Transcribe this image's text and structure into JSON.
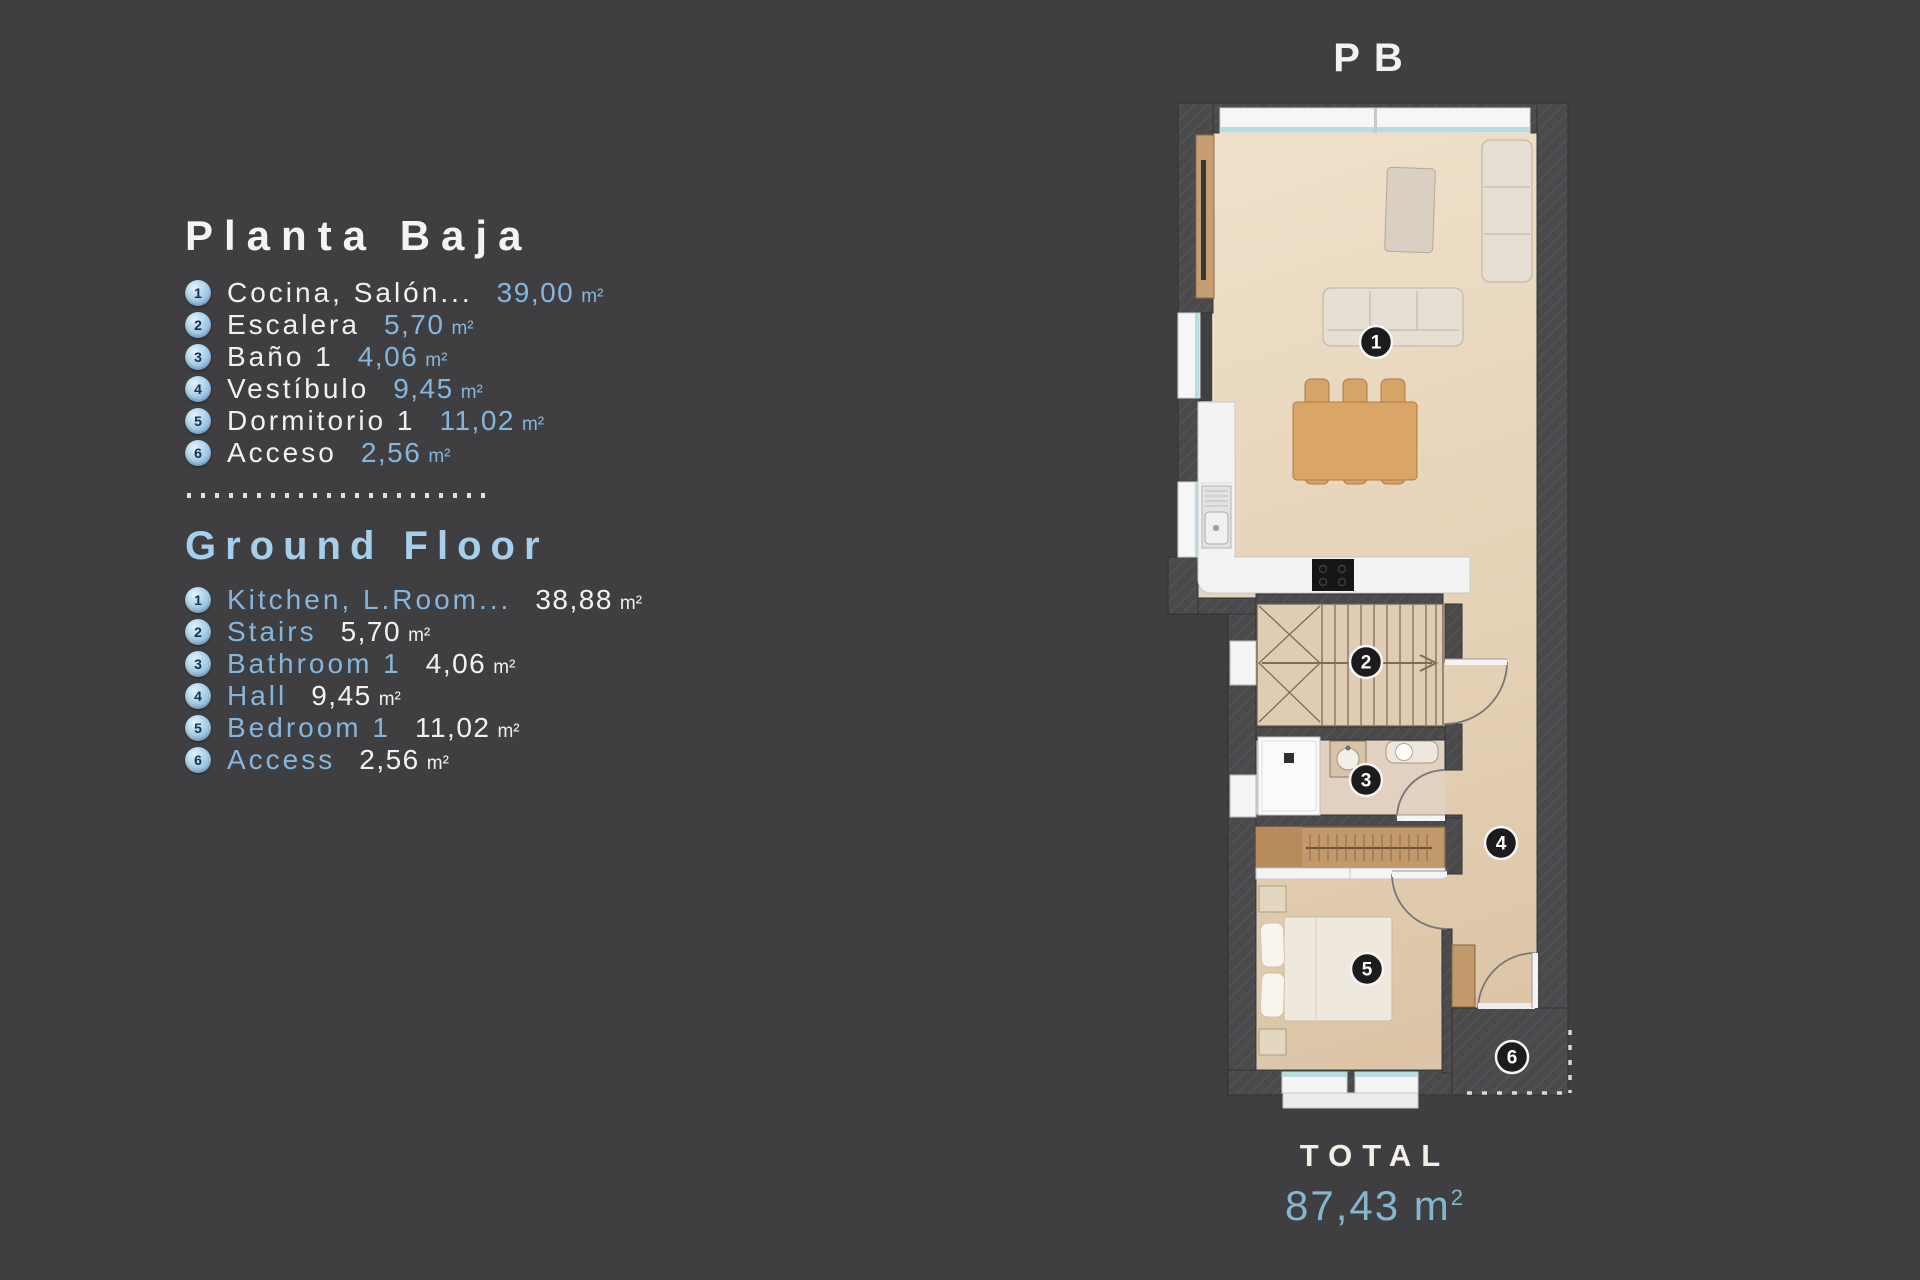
{
  "colors": {
    "background": "#3f3f41",
    "accent_blue": "#85b6dd",
    "heading_blue": "#a6cfec",
    "total_teal": "#83b7cd",
    "text_white": "#f1f1f1"
  },
  "legend": {
    "spanish": {
      "title": "Planta Baja",
      "items": [
        {
          "num": "1",
          "name": "Cocina, Salón...",
          "value": "39,00",
          "unit": "m²"
        },
        {
          "num": "2",
          "name": "Escalera",
          "value": "5,70",
          "unit": "m²"
        },
        {
          "num": "3",
          "name": "Baño 1",
          "value": "4,06",
          "unit": "m²"
        },
        {
          "num": "4",
          "name": "Vestíbulo",
          "value": "9,45",
          "unit": "m²"
        },
        {
          "num": "5",
          "name": "Dormitorio 1",
          "value": "11,02",
          "unit": "m²"
        },
        {
          "num": "6",
          "name": "Acceso",
          "value": "2,56",
          "unit": "m²"
        }
      ]
    },
    "english": {
      "title": "Ground Floor",
      "items": [
        {
          "num": "1",
          "name": "Kitchen, L.Room...",
          "value": "38,88",
          "unit": "m²"
        },
        {
          "num": "2",
          "name": "Stairs",
          "value": "5,70",
          "unit": "m²"
        },
        {
          "num": "3",
          "name": "Bathroom 1",
          "value": "4,06",
          "unit": "m²"
        },
        {
          "num": "4",
          "name": "Hall",
          "value": "9,45",
          "unit": "m²"
        },
        {
          "num": "5",
          "name": "Bedroom 1",
          "value": "11,02",
          "unit": "m²"
        },
        {
          "num": "6",
          "name": "Access",
          "value": "2,56",
          "unit": "m²"
        }
      ]
    }
  },
  "plan": {
    "label": "PB",
    "total": {
      "label": "TOTAL",
      "value": "87,43",
      "unit": "m",
      "sup": "2"
    },
    "markers": [
      {
        "n": "1",
        "x": 1376,
        "y": 342
      },
      {
        "n": "2",
        "x": 1366,
        "y": 662
      },
      {
        "n": "3",
        "x": 1366,
        "y": 780
      },
      {
        "n": "4",
        "x": 1501,
        "y": 843
      },
      {
        "n": "5",
        "x": 1367,
        "y": 969
      },
      {
        "n": "6",
        "x": 1512,
        "y": 1057
      }
    ]
  }
}
